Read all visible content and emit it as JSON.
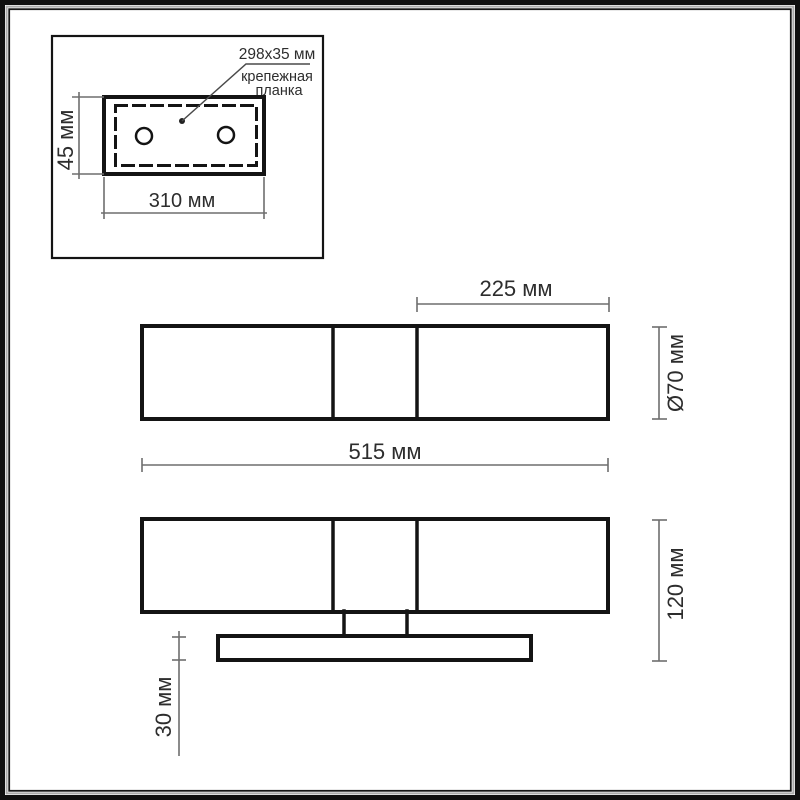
{
  "colors": {
    "drawing_line": "#141414",
    "dimension_line": "#6e6e6e",
    "text": "#2d2d2d",
    "background": "#ffffff",
    "frame": "#101010"
  },
  "inset": {
    "callout_size": "298x35 мм",
    "callout_name_line1": "крепежная",
    "callout_name_line2": "планка",
    "dim_height": "45 мм",
    "dim_width": "310 мм"
  },
  "top_view": {
    "dim_right_segment": "225 мм",
    "dim_diameter": "Ø70 мм",
    "dim_total_width": "515 мм"
  },
  "front_view": {
    "dim_height": "120 мм",
    "dim_plate_thickness": "30 мм"
  }
}
